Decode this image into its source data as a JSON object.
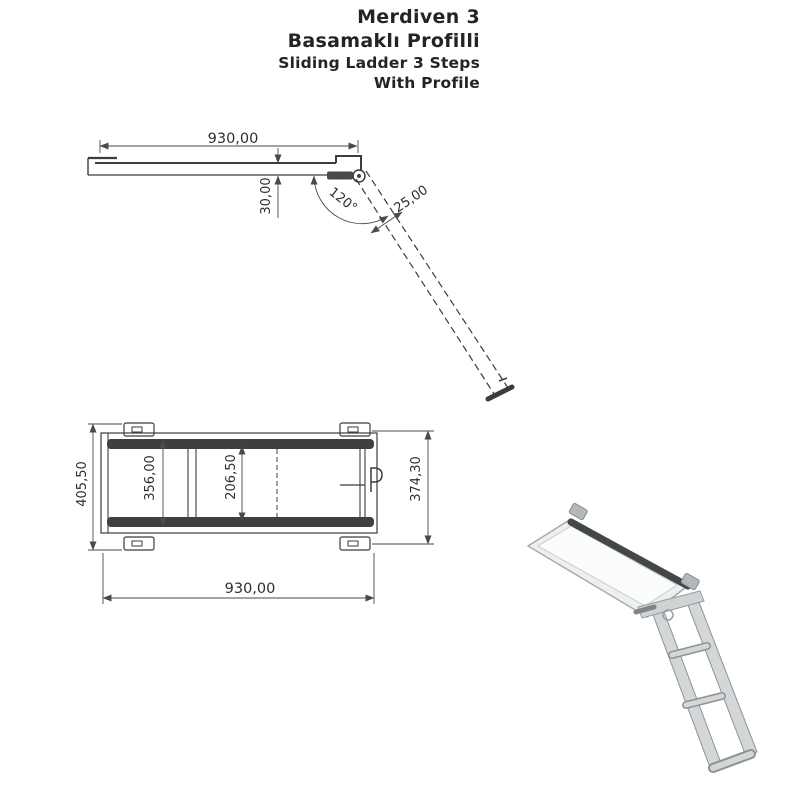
{
  "title": {
    "line1": "Merdiven 3",
    "line2": "Basamaklı Profilli",
    "line3": "Sliding Ladder 3 Steps",
    "line4": "With Profile"
  },
  "side_view": {
    "dims": {
      "length": "930,00",
      "profile_height": "30,00",
      "opening_angle": "120°",
      "profile_width": "25,00"
    }
  },
  "plan_view": {
    "dims": {
      "overall_width": "405,50",
      "rail_span": "356,00",
      "inner_width": "206,50",
      "bracket_span": "374,30",
      "length": "930,00"
    }
  },
  "colors": {
    "background": "#ffffff",
    "drawing_line": "#3c3c3c",
    "dimension_line": "#4a4a4a",
    "text": "#242424",
    "rail_band": "#3f3f3f",
    "render_light": "#d4d7d8",
    "render_mid": "#9aa0a3",
    "render_dark": "#44474a"
  }
}
